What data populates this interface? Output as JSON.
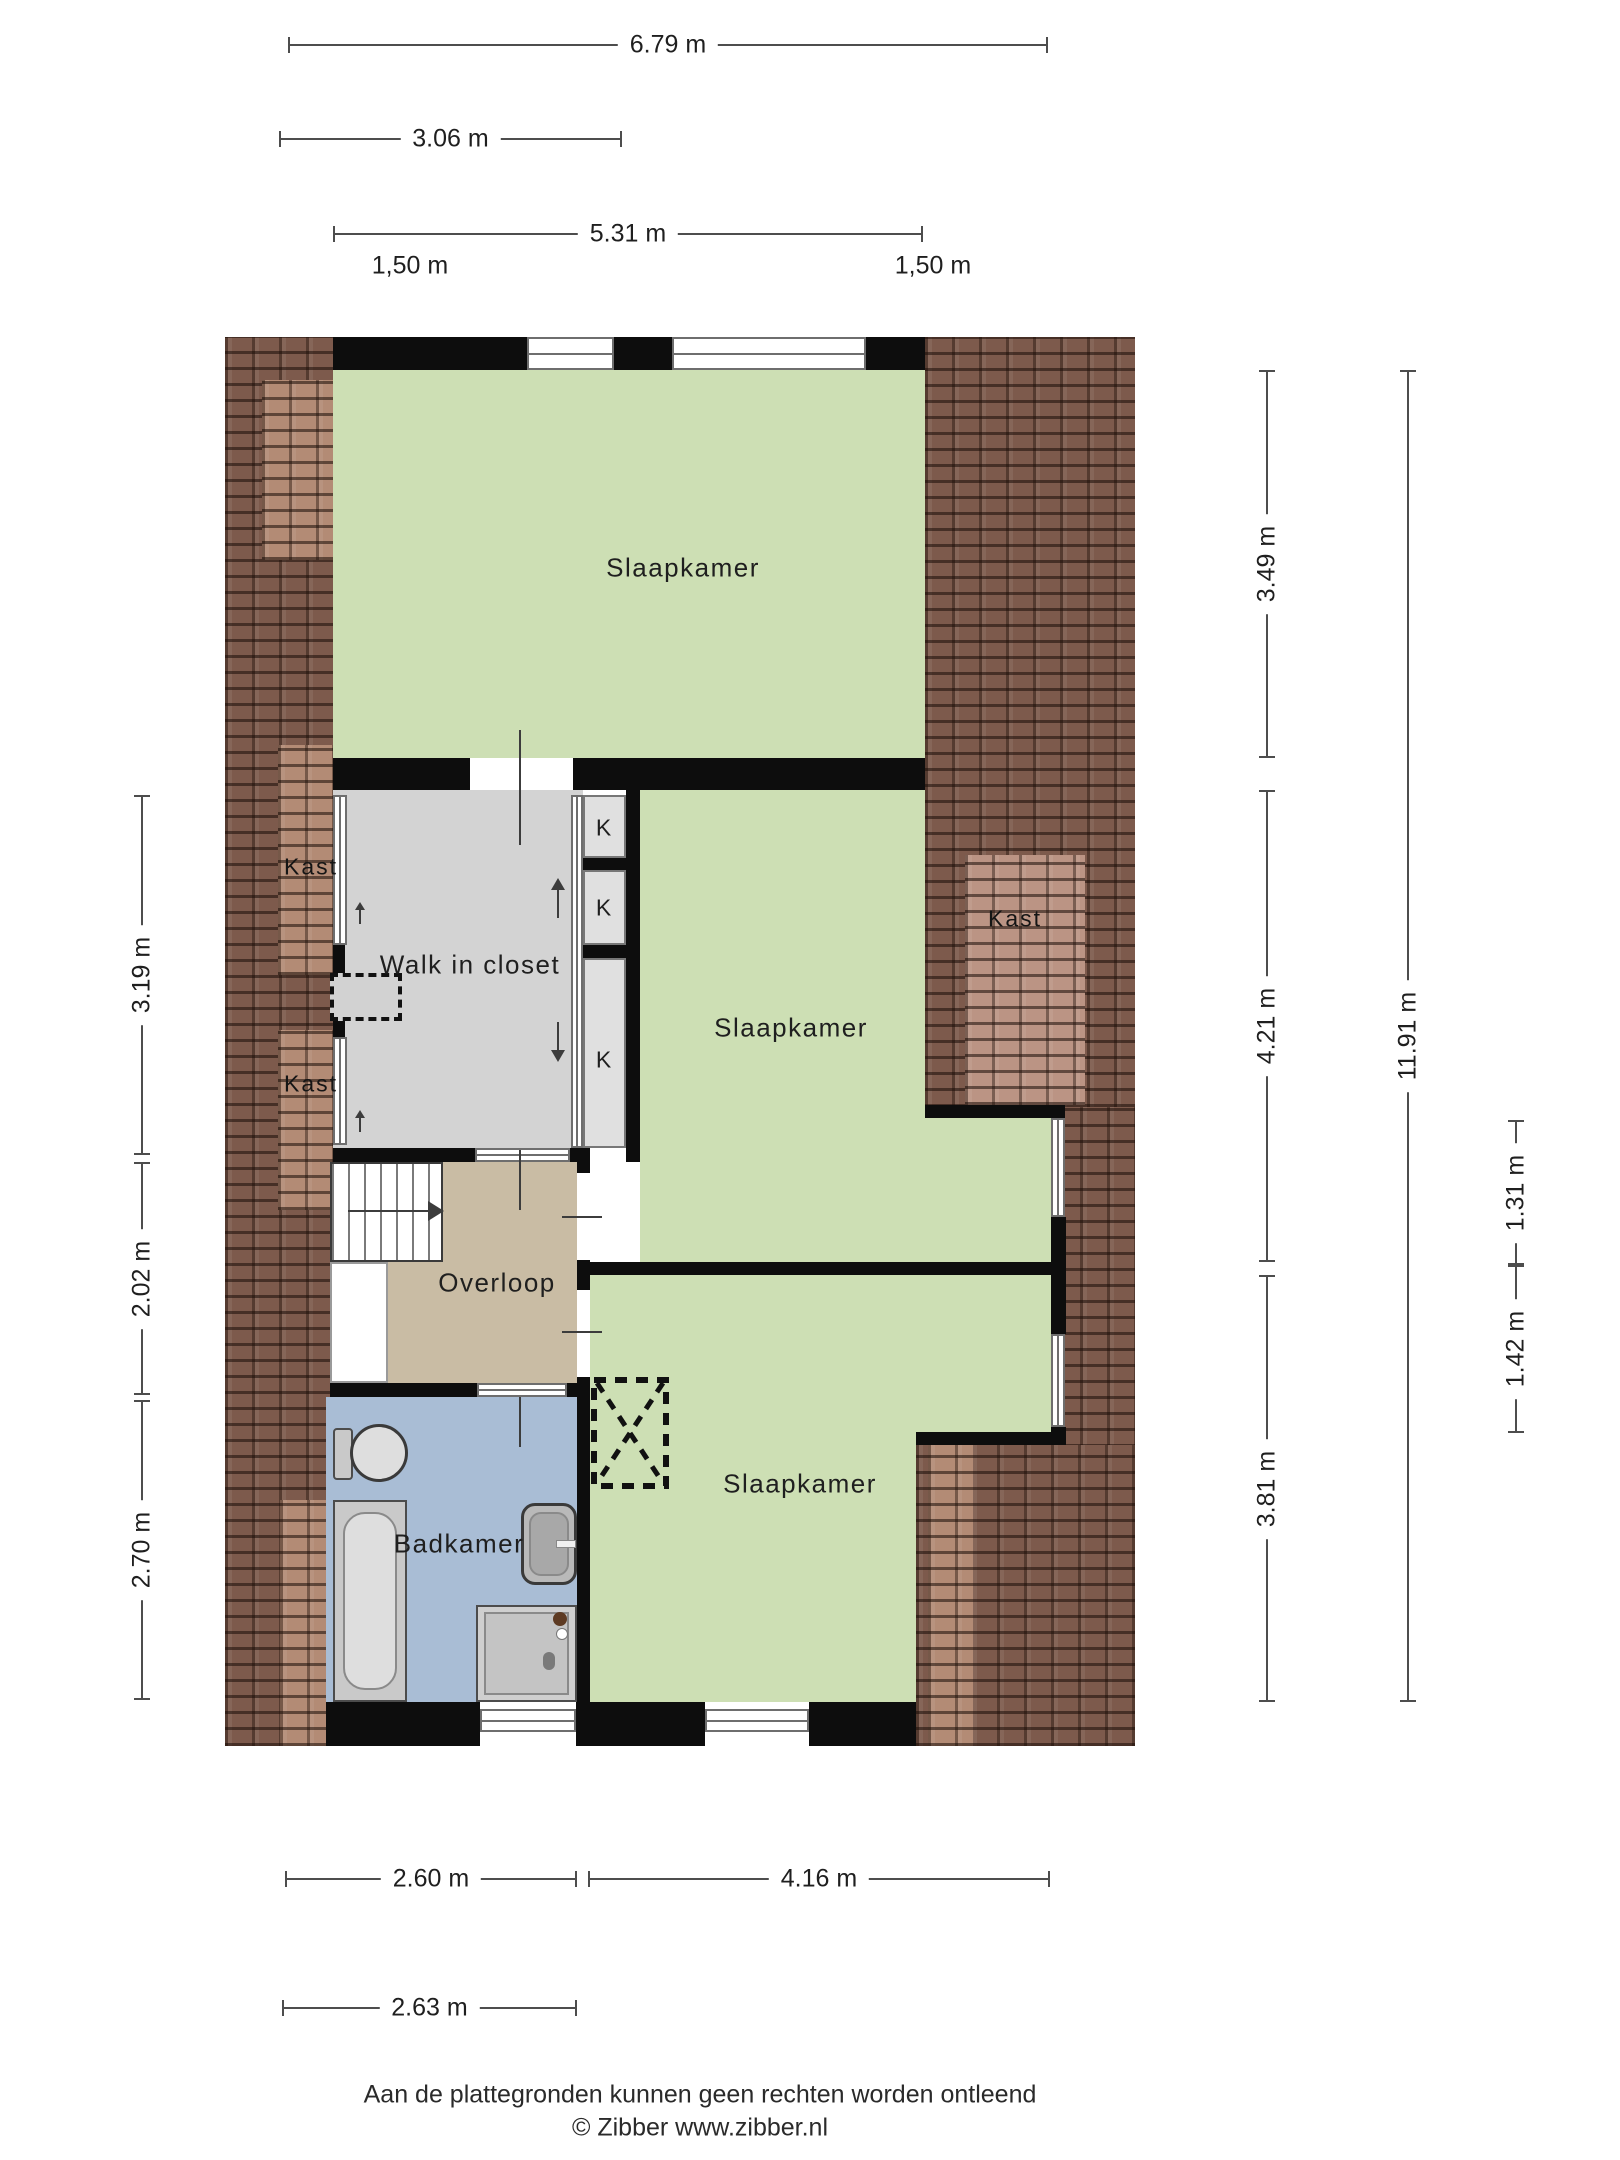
{
  "dimensions": {
    "top": [
      "6.79 m",
      "3.06 m",
      "5.31 m"
    ],
    "knee_left": "1,50 m",
    "knee_right": "1,50 m",
    "left": [
      "3.19 m",
      "2.02 m",
      "2.70 m"
    ],
    "right_inner": [
      "3.49 m",
      "4.21 m",
      "3.81 m"
    ],
    "right_total": "11.91 m",
    "right_small": [
      "1.31 m",
      "1.42 m"
    ],
    "bottom_row1": [
      "2.60 m",
      "4.16 m"
    ],
    "bottom_row2": "2.63 m"
  },
  "rooms": {
    "bedroom_top": "Slaapkamer",
    "bedroom_mid": "Slaapkamer",
    "bedroom_bottom": "Slaapkamer",
    "walk_in_closet": "Walk in closet",
    "landing": "Overloop",
    "bathroom": "Badkamer",
    "closet_left_upper": "Kast",
    "closet_left_lower": "Kast",
    "closet_right": "Kast",
    "k1": "K",
    "k2": "K",
    "k3": "K"
  },
  "footer": {
    "disclaimer": "Aan de plattegronden kunnen geen rechten worden ontleend",
    "copyright": "© Zibber www.zibber.nl"
  },
  "colors": {
    "room_green": "#cddfb4",
    "closet_gray": "#d3d3d3",
    "landing_tan": "#c9bca4",
    "bath_blue": "#a9bdd5",
    "roof_brown": "#7d5a4c",
    "roof_dormer": "#b38b75",
    "wall_black": "#0d0d0d"
  }
}
